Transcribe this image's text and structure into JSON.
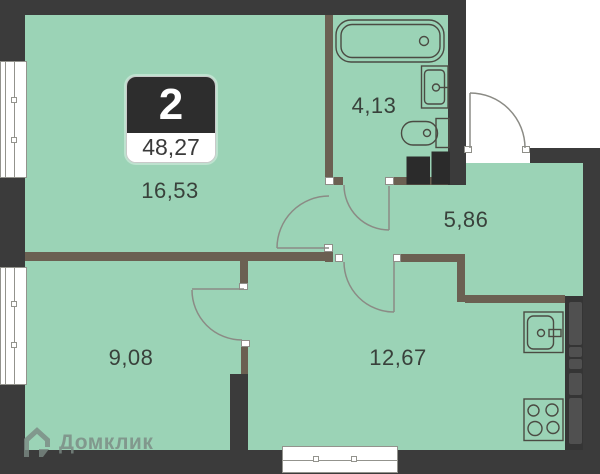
{
  "plan": {
    "badge": {
      "rooms_count": "2",
      "total_area": "48,27"
    },
    "rooms": [
      {
        "name": "living-room",
        "area": "16,53"
      },
      {
        "name": "bathroom",
        "area": "4,13"
      },
      {
        "name": "hallway",
        "area": "5,86"
      },
      {
        "name": "bedroom",
        "area": "9,08"
      },
      {
        "name": "kitchen-living",
        "area": "12,67"
      }
    ],
    "watermark": {
      "brand": "Домклик"
    },
    "colors": {
      "floor": "#9bd3b6",
      "outer_wall": "#3b3b3b",
      "partition_wall": "#6b6052",
      "fixture_outline": "#4b4b43",
      "door_line": "#8b8b85",
      "badge_dark": "#2d2d2d"
    },
    "fixtures": [
      "bathtub",
      "sink",
      "toilet",
      "washing-machine",
      "kitchen-sink",
      "stove",
      "kitchen-counter"
    ]
  }
}
